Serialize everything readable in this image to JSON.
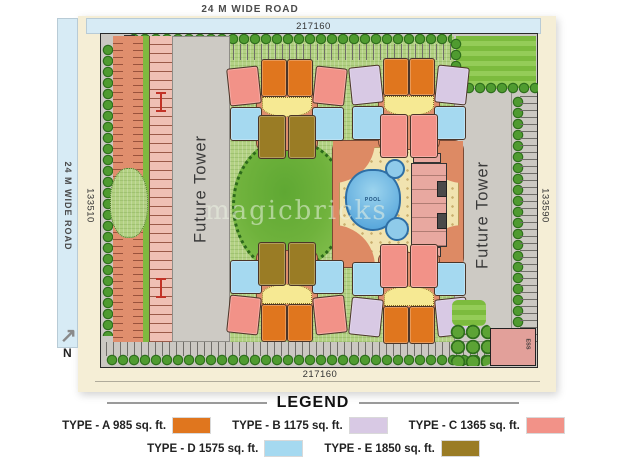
{
  "plan": {
    "roads": {
      "top_label": "24 M WIDE ROAD",
      "left_label": "24 M WIDE ROAD"
    },
    "dimensions": {
      "top": "217160",
      "bottom": "217160",
      "left": "133510",
      "right": "133590"
    },
    "future_tower_left": "Future Tower",
    "future_tower_right": "Future Tower",
    "pool_label": "POOL",
    "ess_label": "ESS",
    "north_label": "N",
    "watermark": "magicbricks",
    "clusters": [
      {
        "position": "top-left",
        "orientation": "normal",
        "corner_type": "C",
        "top_center_type": "A",
        "side_type": "D",
        "inner_center_type": "E"
      },
      {
        "position": "top-right",
        "orientation": "normal",
        "corner_type": "B",
        "top_center_type": "A",
        "side_type": "D",
        "inner_center_type": "C"
      },
      {
        "position": "bottom-left",
        "orientation": "flipped",
        "corner_type": "C",
        "top_center_type": "A",
        "side_type": "D",
        "inner_center_type": "E"
      },
      {
        "position": "bottom-right",
        "orientation": "flipped",
        "corner_type": "B",
        "top_center_type": "A",
        "side_type": "D",
        "inner_center_type": "C"
      }
    ]
  },
  "legend": {
    "title": "LEGEND",
    "rows": [
      3,
      2
    ],
    "items": [
      {
        "type": "A",
        "label": "TYPE - A 985 sq. ft.",
        "color": "#E0761E"
      },
      {
        "type": "B",
        "label": "TYPE - B 1175 sq. ft.",
        "color": "#D8C9E4"
      },
      {
        "type": "C",
        "label": "TYPE - C 1365 sq. ft.",
        "color": "#F29288"
      },
      {
        "type": "D",
        "label": "TYPE - D 1575 sq. ft.",
        "color": "#A5D9F0"
      },
      {
        "type": "E",
        "label": "TYPE - E 1850 sq. ft.",
        "color": "#9A7C25"
      }
    ]
  },
  "colors": {
    "cream": "#F5EED6",
    "road_gray": "#CBC8C2",
    "tower_gray": "#CDCAC4",
    "salmon": "#E08E6D",
    "cluster_core": "#DE8E6C",
    "courtyard": "#F6E993",
    "lawn": "#B3D183",
    "oval_green": "#5FA833",
    "pool_blue": "#5AA8DC",
    "blue_band": "#D7EBF5"
  }
}
